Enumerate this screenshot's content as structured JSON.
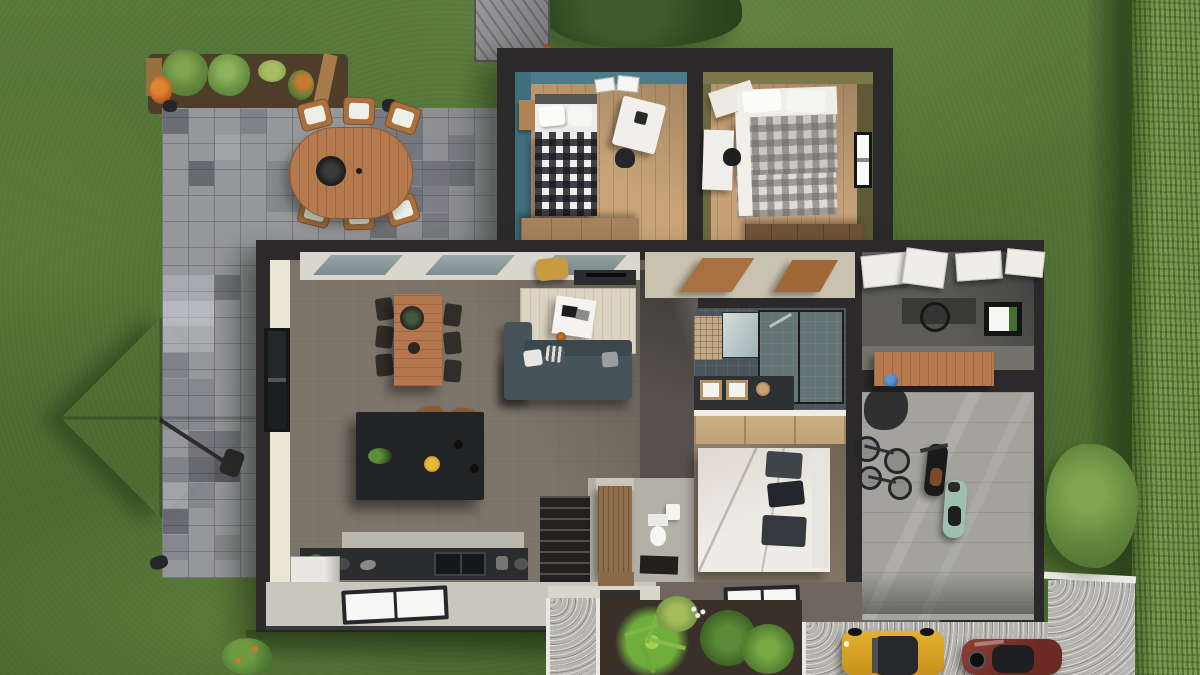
{
  "scene": {
    "label": "Aerial 3D cut-away rendering of a single-storey house, garden, patio and driveway",
    "view": "top-down"
  },
  "palette": {
    "lawn": "#527134",
    "hedge": "#7d9a4f",
    "paver": "#96979b",
    "wall": "#2b292a",
    "wood_floor": "#c9a478",
    "living_floor": "#7d756a",
    "teal_wall": "#40707e",
    "olive_wall": "#6b683f",
    "cream_wall": "#eae6d7",
    "sofa": "#46545a",
    "rug": "#dcd3c2",
    "island": "#212325",
    "ledge": "#c9c6bd",
    "gravel": "#b6b4ae",
    "car_yellow": "#d8a225",
    "car_red": "#7b312b",
    "parasol": "#cfceca",
    "scooter_mint": "#9fc0ae"
  },
  "garden": {
    "lawn": {
      "label": "Lawn"
    },
    "hedge": {
      "label": "Boundary hedge"
    },
    "tree": {
      "label": "Tree canopy"
    },
    "shed": {
      "label": "Garden shed"
    },
    "flower_bed": {
      "label": "Flower bed with shrubs and orange flowers"
    },
    "patio": {
      "label": "Stone paver patio"
    },
    "outdoor_dining": {
      "label": "Oval teak dining table with six chairs",
      "seats": 6
    },
    "grill": {
      "label": "Table-top grill bowl"
    },
    "parasol": {
      "label": "Cantilever parasol"
    },
    "front_path": {
      "label": "Front entrance path"
    },
    "plant_bed": {
      "label": "Tropical plant bed"
    },
    "driveway": {
      "label": "Gravel driveway"
    },
    "car_yellow": {
      "label": "Yellow car",
      "color": "#d8a225"
    },
    "car_red": {
      "label": "Dark red car",
      "color": "#7b312b"
    },
    "bush": {
      "label": "Garden bush"
    },
    "shrub": {
      "label": "Flowering shrub"
    }
  },
  "house": {
    "bedroom_teal": {
      "label": "Bedroom 1 - teal accent walls",
      "items": [
        "single bed with black and white gingham duvet",
        "white desk and chair",
        "nightstand",
        "wooden dresser",
        "wall posters"
      ]
    },
    "bedroom_olive": {
      "label": "Bedroom 2 - olive green walls",
      "items": [
        "double bed with grey plaid duvet",
        "white desk with black chair",
        "window",
        "dark wood dresser",
        "white floor mat"
      ]
    },
    "hallway": {
      "label": "Hallway with open wooden doors"
    },
    "living_room": {
      "label": "Open-plan living room",
      "items": [
        "wooden dining table with six chairs",
        "dark kitchen island with two bar stools",
        "corner sofa with cushions",
        "cream rug with white coffee table",
        "mustard armchair",
        "media console",
        "glazed sliding doors",
        "full-height window"
      ]
    },
    "kitchen": {
      "label": "Kitchen worktop with double sink and refrigerator"
    },
    "entry": {
      "label": "Entrance hall with staircase, wooden cupboard and doormat"
    },
    "wc": {
      "label": "WC with toilet and hand basin"
    },
    "bathroom": {
      "label": "Bathroom with walk-in glass shower, mirror and double vanity"
    },
    "wardrobe": {
      "label": "Sliding-door wardrobe"
    },
    "bedroom_master": {
      "label": "Bedroom 3 - double bed, white duvet, dark pillows"
    },
    "utility": {
      "label": "Utility room with white cabinets, desk and garden window"
    },
    "workshop": {
      "label": "Workbench with blue helmet"
    },
    "garage": {
      "label": "Garage",
      "items": [
        "two bicycles",
        "black motorcycle",
        "mint scooter"
      ]
    },
    "roof": {
      "label": "Cut-away roof ledge with skylights"
    },
    "porch": {
      "label": "Entrance porch"
    }
  }
}
